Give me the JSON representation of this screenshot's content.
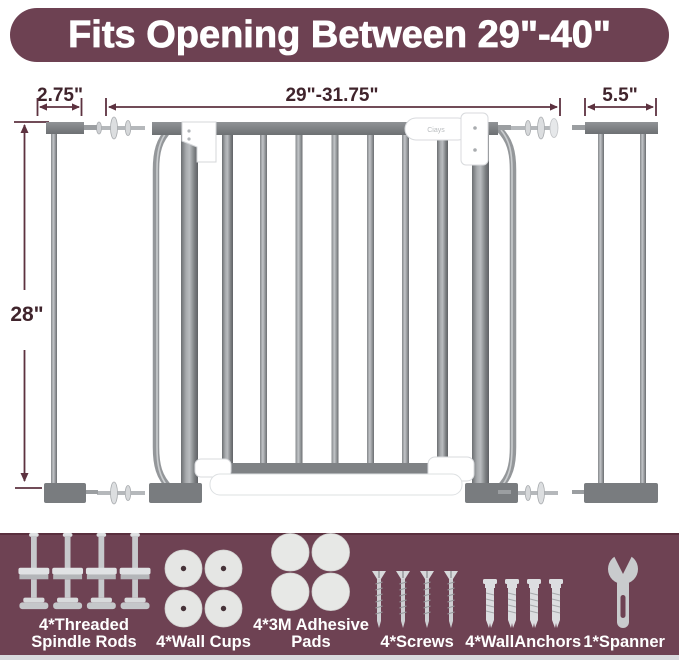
{
  "banner": {
    "title": "Fits Opening Between 29\"-40\"",
    "bg_color": "#6d4152",
    "text_color": "#ffffff"
  },
  "diagram": {
    "dimensions": {
      "left_extension_width": "2.75\"",
      "gate_opening_width": "29\"-31.75\"",
      "right_extension_width": "5.5\"",
      "gate_height": "28\""
    },
    "brand_label": "Ciays",
    "colors": {
      "dimension_text": "#40242c",
      "dimension_line": "#5d3240",
      "gate_gray": "#8e9194",
      "gate_dark_gray": "#7c7f82",
      "hardware_white": "#ffffff"
    }
  },
  "included_items": [
    {
      "name": "threaded-spindle-rods",
      "quantity": 4,
      "label_lines": [
        "4*Threaded",
        "Spindle Rods"
      ]
    },
    {
      "name": "wall-cups",
      "quantity": 4,
      "label_lines": [
        "4*Wall Cups"
      ]
    },
    {
      "name": "3m-adhesive-pads",
      "quantity": 4,
      "label_lines": [
        "4*3M Adhesive",
        "Pads"
      ]
    },
    {
      "name": "screws",
      "quantity": 4,
      "label_lines": [
        "4*Screws"
      ]
    },
    {
      "name": "wall-anchors",
      "quantity": 4,
      "label_lines": [
        "4*WallAnchors"
      ]
    },
    {
      "name": "spanner",
      "quantity": 1,
      "label_lines": [
        "1*Spanner"
      ]
    }
  ],
  "strip_bg_color": "#6e4253"
}
